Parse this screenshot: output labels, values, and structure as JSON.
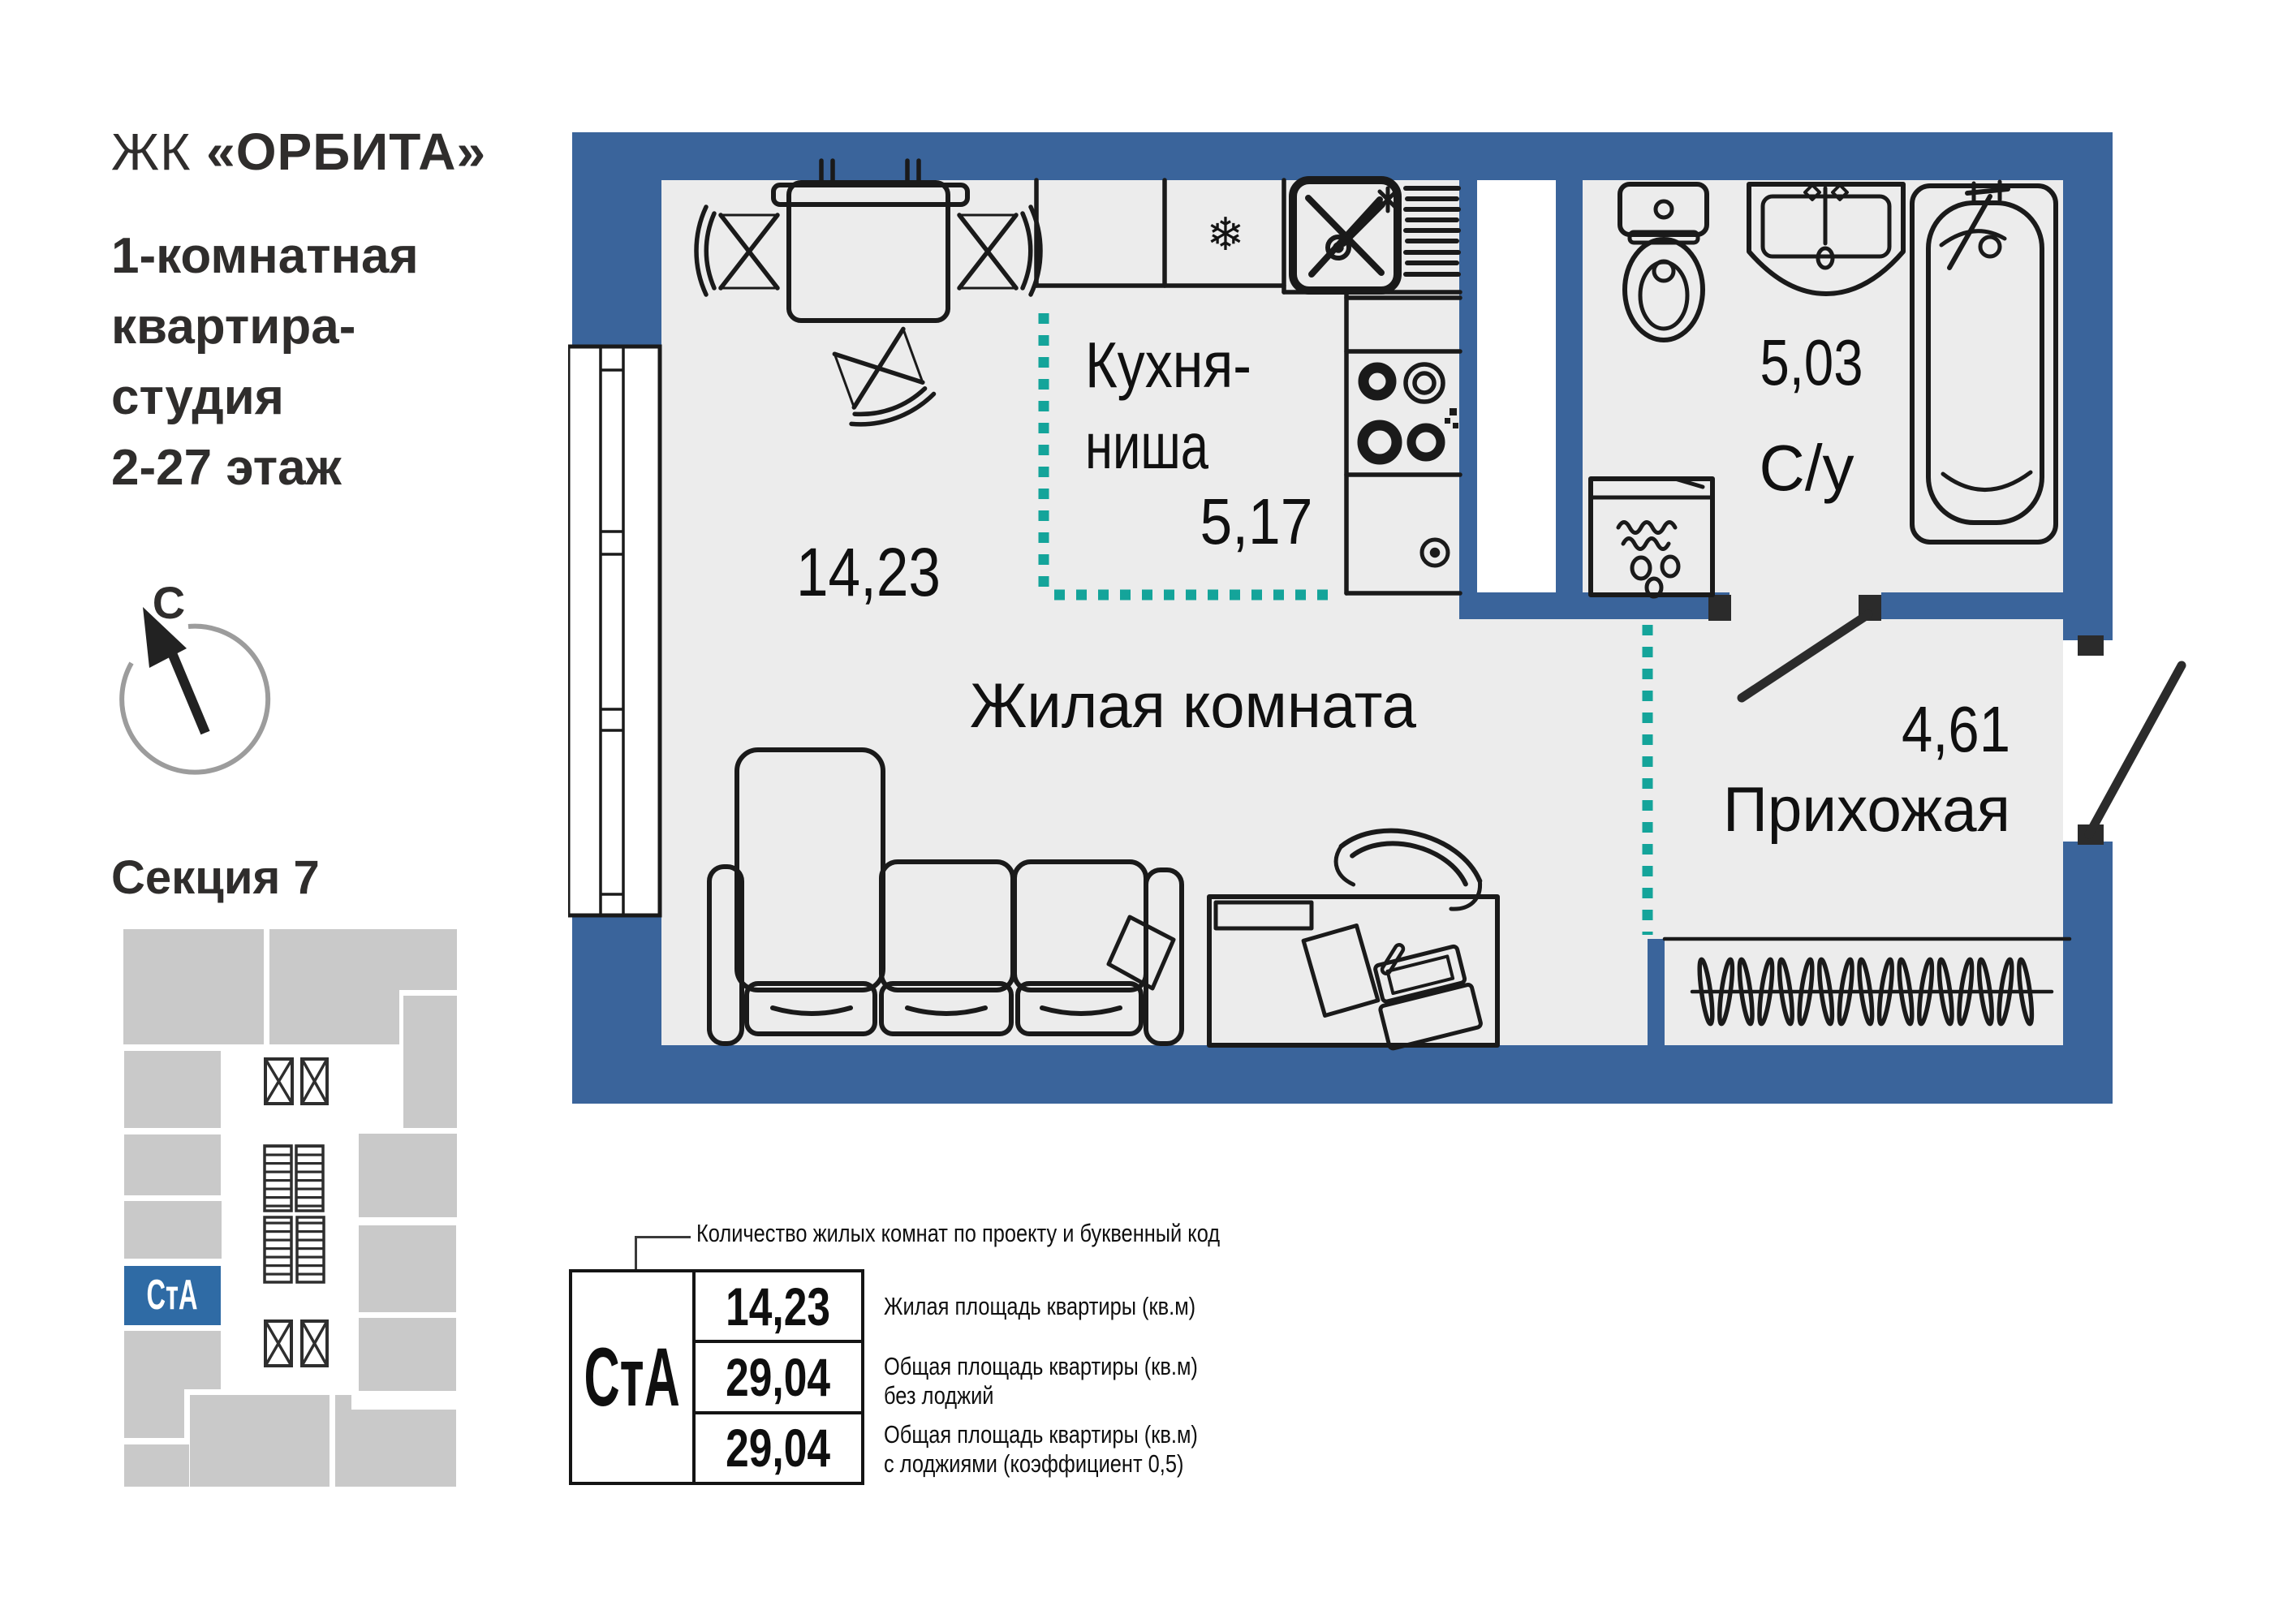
{
  "header": {
    "project_prefix": "ЖК",
    "project_name": "«ОРБИТА»",
    "subtitle_lines": [
      "1-комнатная",
      "квартира-",
      "студия",
      "2-27 этаж"
    ]
  },
  "compass": {
    "north_label": "С"
  },
  "section": {
    "title": "Секция 7",
    "unit_code": "СтА"
  },
  "floor_plan": {
    "rooms": {
      "kitchen": {
        "name_line1": "Кухня-",
        "name_line2": "ниша",
        "area": "5,17"
      },
      "living": {
        "name": "Жилая комната",
        "area": "14,23"
      },
      "bathroom": {
        "name": "С/у",
        "area": "5,03"
      },
      "hallway": {
        "name": "Прихожая",
        "area": "4,61"
      }
    },
    "icons": {
      "fridge_snowflake": "❄"
    }
  },
  "legend": {
    "callout": "Количество жилых комнат по проекту и буквенный код",
    "unit_code": "СтА",
    "rows": [
      {
        "value": "14,23",
        "label1": "Жилая площадь квартиры (кв.м)",
        "label2": ""
      },
      {
        "value": "29,04",
        "label1": "Общая площадь квартиры (кв.м)",
        "label2": "без лоджий"
      },
      {
        "value": "29,04",
        "label1": "Общая площадь квартиры (кв.м)",
        "label2": "с лоджиями (коэффициент 0,5)"
      }
    ]
  },
  "colors": {
    "wall": "#3A649B",
    "accent": "#2F6BA5",
    "floor": "#ECECEC",
    "dash": "#14A49A",
    "kp": "#C9C9C9",
    "ink": "#1a1a1a"
  }
}
